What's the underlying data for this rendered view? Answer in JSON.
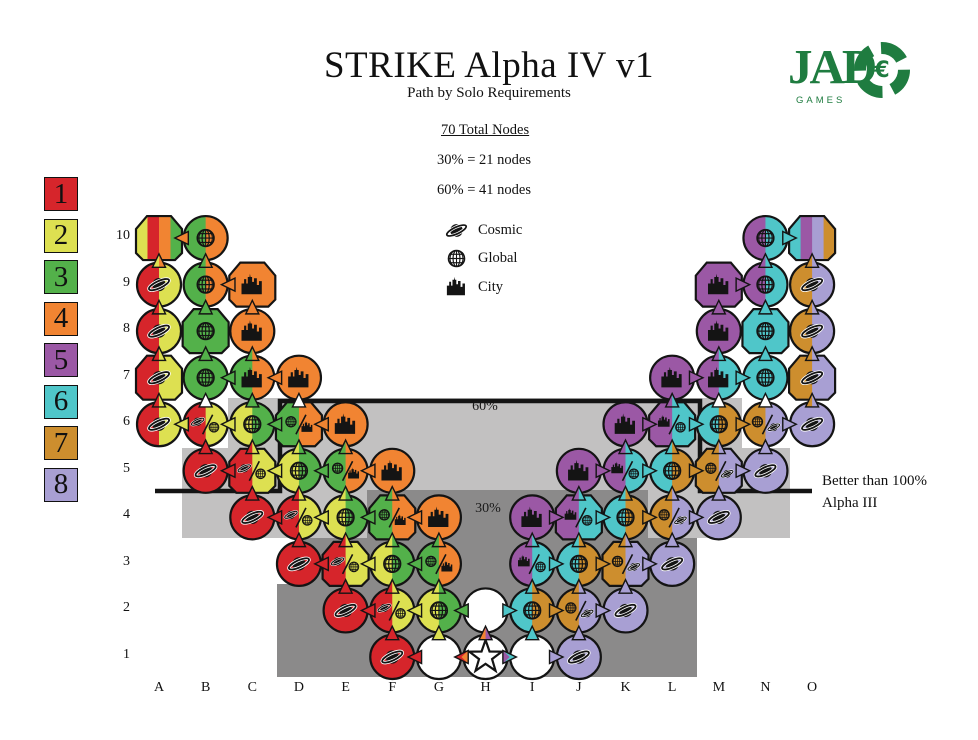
{
  "title": "STRIKE Alpha IV v1",
  "subtitle": "Path by Solo Requirements",
  "logo": {
    "word": "JAD",
    "chip_letter": "€",
    "subtext": "GAMES",
    "color": "#1f7c40"
  },
  "stats": {
    "total": "70 Total Nodes",
    "pct30": "30% = 21 nodes",
    "pct60": "60% = 41 nodes"
  },
  "icon_legend": [
    {
      "icon": "cosmic-icon",
      "label": "Cosmic"
    },
    {
      "icon": "global-icon",
      "label": "Global"
    },
    {
      "icon": "city-icon",
      "label": "City"
    }
  ],
  "tier_legend": [
    {
      "n": "1",
      "color": "#d6252b"
    },
    {
      "n": "2",
      "color": "#dde051"
    },
    {
      "n": "3",
      "color": "#53b14a"
    },
    {
      "n": "4",
      "color": "#f18432"
    },
    {
      "n": "5",
      "color": "#9b58a5"
    },
    {
      "n": "6",
      "color": "#4fc6c9"
    },
    {
      "n": "7",
      "color": "#cd8e2e"
    },
    {
      "n": "8",
      "color": "#a89fd3"
    }
  ],
  "region_labels": {
    "sixty": "60%",
    "thirty": "30%"
  },
  "annotation": [
    "Better than 100%",
    "Alpha III"
  ],
  "columns": [
    "A",
    "B",
    "C",
    "D",
    "E",
    "F",
    "G",
    "H",
    "I",
    "J",
    "K",
    "L",
    "M",
    "N",
    "O"
  ],
  "rows": [
    "1",
    "2",
    "3",
    "4",
    "5",
    "6",
    "7",
    "8",
    "9",
    "10"
  ],
  "palette": {
    "1": "#d6252b",
    "2": "#dde051",
    "3": "#53b14a",
    "4": "#f18432",
    "5": "#9b58a5",
    "6": "#4fc6c9",
    "7": "#cd8e2e",
    "8": "#a89fd3",
    "W": "#ffffff",
    "light_zone": "#c2c1c1",
    "dark_zone": "#8b8a8a",
    "ink": "#141414"
  },
  "zones": {
    "light": [
      [
        228,
        398,
        514,
        50
      ],
      [
        182,
        448,
        608,
        42
      ],
      [
        182,
        490,
        185,
        48
      ],
      [
        648,
        490,
        142,
        48
      ]
    ],
    "dark": [
      [
        367,
        490,
        281,
        48
      ],
      [
        300,
        538,
        397,
        46
      ],
      [
        277,
        584,
        420,
        93
      ]
    ]
  },
  "nodes": [
    "A10:P:2143:",
    "B10:C:34:g",
    "N10:C:56:g",
    "O10:P:6587:",
    "A9:C:12:c",
    "B9:C:34:g",
    "C9:P:4:t",
    "M9:P:5:t",
    "N9:C:56:g",
    "O9:C:78:c",
    "A8:C:12:c",
    "B8:P:3:g",
    "C8:C:4:t",
    "M8:C:5:t",
    "N8:P:6:g",
    "O8:C:78:c",
    "A7:P:12:c",
    "B7:C:3:g",
    "C7:C:34:t",
    "D7:C:4:t",
    "L7:C:5:t",
    "M7:C:56:t",
    "N7:C:6:g",
    "O7:P:78:c",
    "A6:C:12:c",
    "B6:C:12:cg",
    "C6:C:23:g",
    "D6:P:34:gt",
    "E6:C:4:t",
    "K6:C:5:t",
    "L6:P:56:tg",
    "M6:C:67:g",
    "N6:C:78:gc",
    "O6:C:8:c",
    "B5:C:1:c",
    "C5:P:12:cg",
    "D5:C:23:g",
    "E5:C:34:gt",
    "F5:C:4:t",
    "J5:C:5:t",
    "K5:C:56:tg",
    "L5:C:67:g",
    "M5:P:78:gc",
    "N5:C:8:c",
    "C4:C:1:c",
    "D4:C:12:cg",
    "E4:C:23:g",
    "F4:P:34:gt",
    "G4:C:4:t",
    "I4:C:5:t",
    "J4:P:56:tg",
    "K4:C:67:g",
    "L4:C:78:gc",
    "M4:C:8:c",
    "D3:C:1:c",
    "E3:P:12:cg",
    "F3:C:23:g",
    "G3:C:34:gt",
    "I3:C:56:tg",
    "J3:C:67:g",
    "K3:P:78:gc",
    "L3:C:8:c",
    "E2:C:1:c",
    "F2:C:12:cg",
    "G2:C:23:g",
    "H2:C:W:",
    "I2:C:67:g",
    "J2:C:78:gc",
    "K2:C:8:c",
    "F1:C:1:c",
    "G1:C:W:",
    "H1:C:W:s",
    "I1:C:W:",
    "J1:C:8:c"
  ],
  "arrows_h": [
    "B10-A10:4",
    "N10-O10:6",
    "C9-B9:4",
    "M9-N9:5",
    "C7-B7:3",
    "D7-C7:4",
    "L7-M7:5",
    "M7-N7:6",
    "B6-A6:2",
    "C6-B6:2",
    "D6-C6:3",
    "E6-D6:4",
    "K6-L6:5",
    "L6-M6:6",
    "M6-N6:7",
    "N6-O6:8",
    "C5-B5:1",
    "D5-C5:2",
    "E5-D5:3",
    "F5-E5:4",
    "J5-K5:5",
    "K5-L5:6",
    "L5-M5:7",
    "M5-N5:8",
    "D4-C4:1",
    "E4-D4:2",
    "F4-E4:3",
    "G4-F4:4",
    "I4-J4:5",
    "J4-K4:6",
    "K4-L4:7",
    "L4-M4:8",
    "E3-D3:1",
    "F3-E3:2",
    "G3-F3:3",
    "I3-J3:6",
    "J3-K3:7",
    "K3-L3:8",
    "F2-E2:1",
    "G2-F2:2",
    "H2-G2:3",
    "H2-I2:6",
    "I2-J2:7",
    "J2-K2:8",
    "G1-F1:1",
    "H1-G1:1,4",
    "H1-I1:6,5",
    "I1-J1:8"
  ],
  "arrows_v": [
    "A6-7:1,2",
    "A7-8:1,2",
    "A8-9:1,2",
    "A9-10:2,4",
    "B5-6:1",
    "B6-7:W",
    "B7-8:3",
    "B8-9:3",
    "B9-10:3,4",
    "C4-5:1",
    "C5-6:1,2",
    "C6-7:3",
    "C7-8:3,4",
    "C8-9:4",
    "D3-4:1",
    "D4-5:1,2",
    "D5-6:2,3",
    "D6-7:W",
    "E2-3:1",
    "E3-4:1,2",
    "E4-5:2,3",
    "E5-6:3,4",
    "F1-2:1",
    "F2-3:1,2",
    "F3-4:2,3",
    "F4-5:3,4",
    "G1-2:2",
    "G2-3:2,3",
    "G3-4:3,4",
    "H1-2:4,5",
    "I1-2:6",
    "I2-3:6,7",
    "I3-4:5,6",
    "J1-2:8",
    "J2-3:7,8",
    "J3-4:6,7",
    "J4-5:5,6",
    "K2-3:8",
    "K3-4:7,8",
    "K4-5:6,7",
    "K5-6:5,6",
    "L3-4:8",
    "L4-5:7,8",
    "L5-6:6,7",
    "L6-7:5,6",
    "M4-5:8",
    "M5-6:7,8",
    "M6-7:W",
    "M7-8:5,6",
    "M8-9:5",
    "N5-6:8",
    "N6-7:W",
    "N7-8:6",
    "N8-9:6",
    "N9-10:5,6",
    "O6-7:7,8",
    "O7-8:7,8",
    "O8-9:7,8",
    "O9-10:7,8"
  ]
}
